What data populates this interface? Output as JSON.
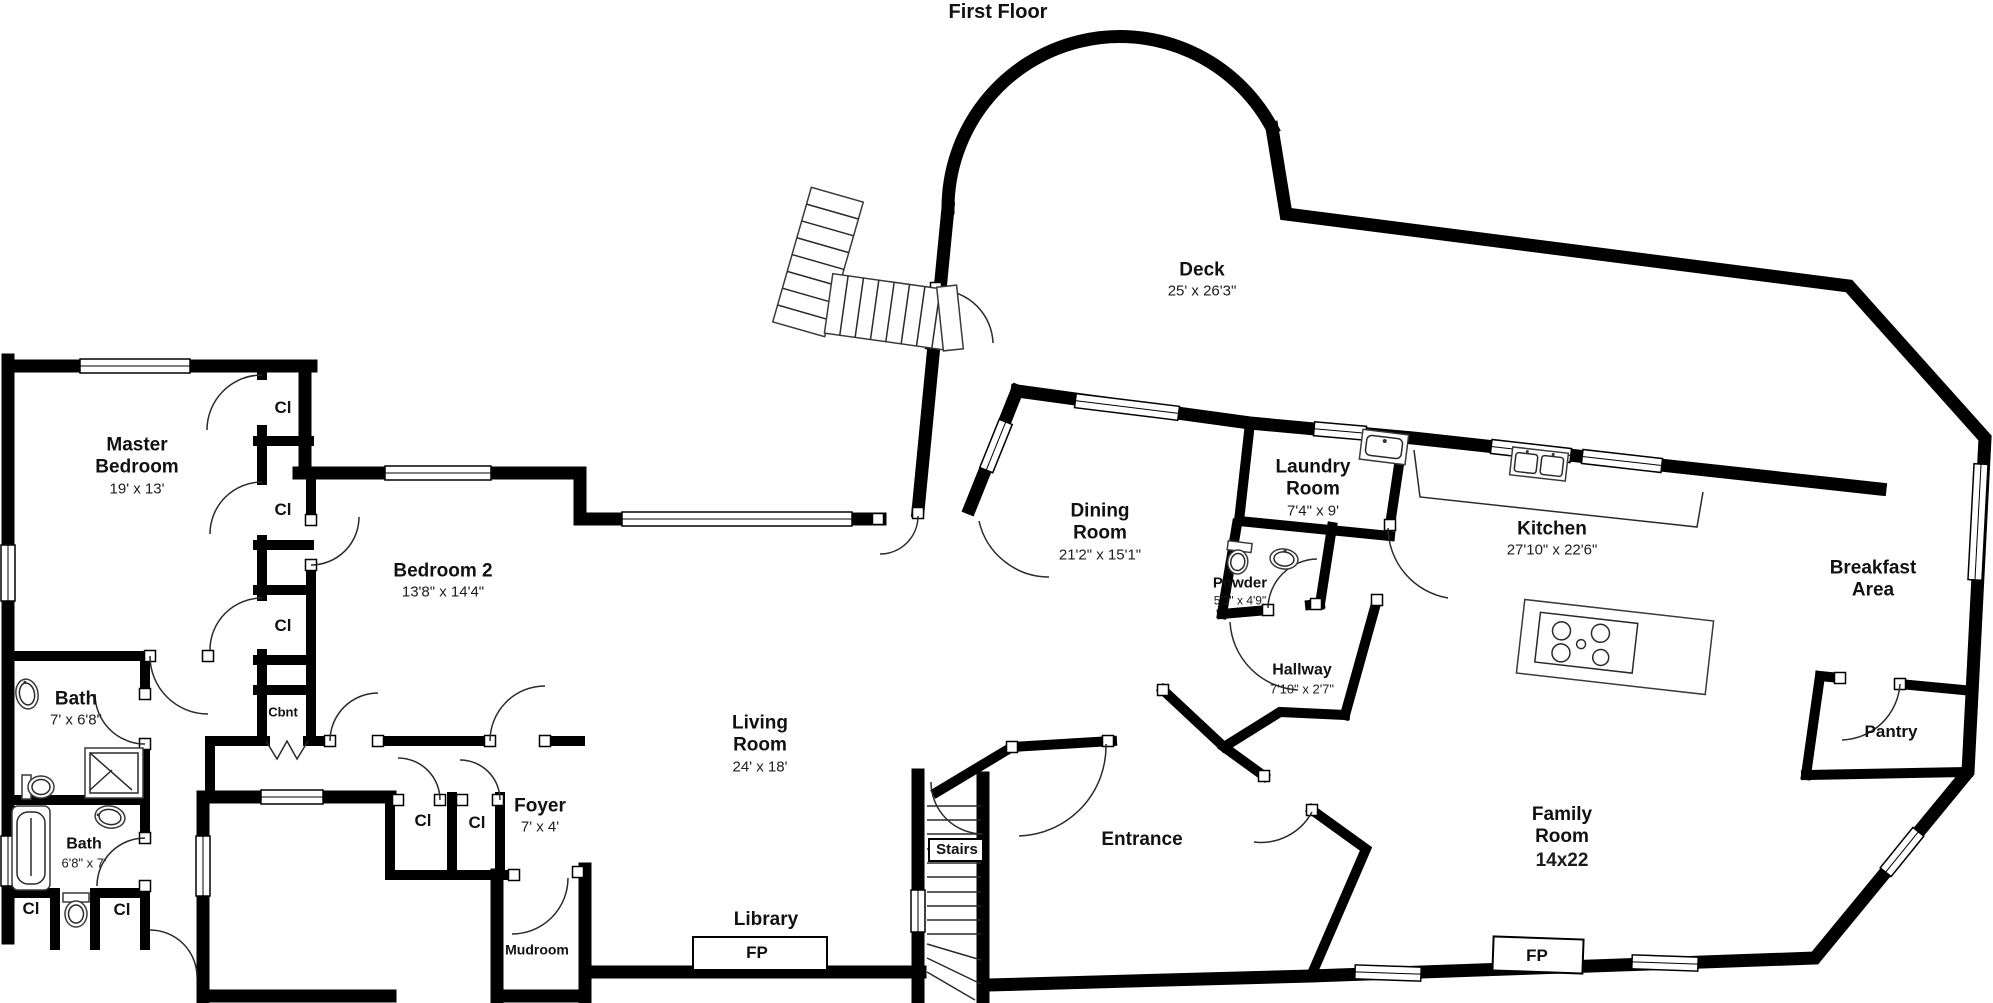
{
  "title": "First Floor",
  "colors": {
    "wall": "#000000",
    "background": "#ffffff",
    "text": "#111111"
  },
  "labels": {
    "closet": "Cl",
    "cabinet": "Cbnt",
    "fireplace": "FP",
    "stairs": "Stairs"
  },
  "rooms": [
    {
      "name": "Master Bedroom",
      "dims": "19' x 13'"
    },
    {
      "name": "Bedroom 2",
      "dims": "13'8\" x 14'4\""
    },
    {
      "name": "Bath",
      "dims": "7' x 6'8\""
    },
    {
      "name": "Bath",
      "dims": "6'8\" x 7'"
    },
    {
      "name": "Living Room",
      "dims": "24' x 18'"
    },
    {
      "name": "Foyer",
      "dims": "7' x 4'"
    },
    {
      "name": "Library",
      "dims": ""
    },
    {
      "name": "Mudroom",
      "dims": ""
    },
    {
      "name": "Dining Room",
      "dims": "21'2\" x 15'1\""
    },
    {
      "name": "Laundry Room",
      "dims": "7'4\" x 9'"
    },
    {
      "name": "Powder",
      "dims": "5'3\" x 4'9\""
    },
    {
      "name": "Hallway",
      "dims": "7'10\" x 2'7\""
    },
    {
      "name": "Kitchen",
      "dims": "27'10\" x  22'6\""
    },
    {
      "name": "Breakfast Area",
      "dims": ""
    },
    {
      "name": "Pantry",
      "dims": ""
    },
    {
      "name": "Family Room",
      "dims": "14x22"
    },
    {
      "name": "Entrance",
      "dims": ""
    },
    {
      "name": "Deck",
      "dims": "25' x 26'3\""
    }
  ]
}
